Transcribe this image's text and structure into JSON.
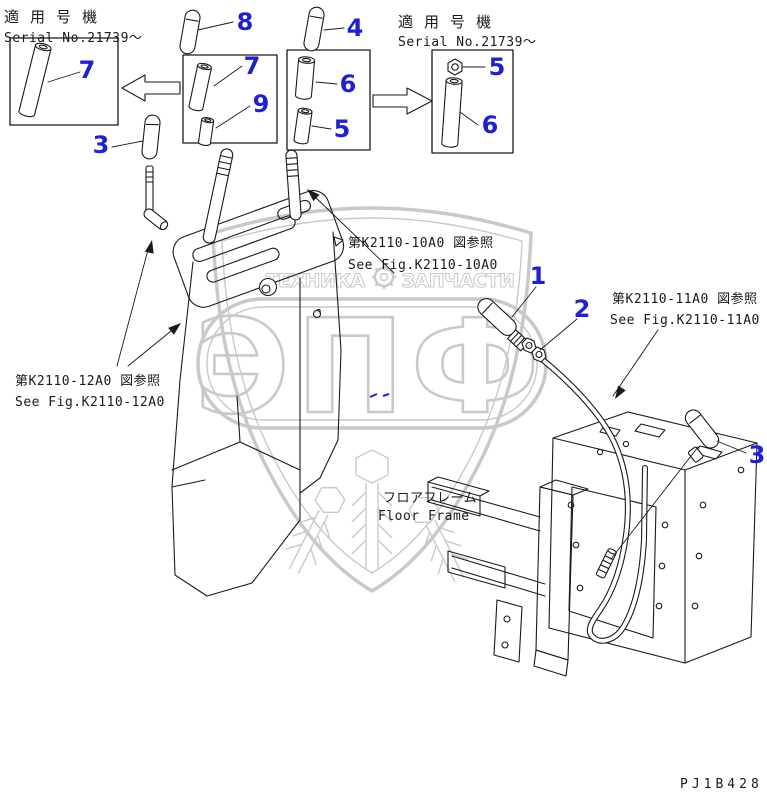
{
  "colors": {
    "ink": "#1a1a1a",
    "accent": "#1f1fd6",
    "watermark": "#c9c9c9",
    "bg": "#ffffff"
  },
  "headers": {
    "left": {
      "kanji": "適 用 号 機",
      "serial": "Serial No.21739～"
    },
    "right": {
      "kanji": "適 用 号 機",
      "serial": "Serial No.21739～"
    }
  },
  "callouts": {
    "n1": "1",
    "n2": "2",
    "n3_left": "3",
    "n3_right": "3",
    "n4": "4",
    "n5_box3": "5",
    "n5_box4": "5",
    "n6_box3": "6",
    "n6_box4": "6",
    "n7_box1": "7",
    "n7_box2": "7",
    "n8": "8",
    "n9": "9"
  },
  "refs": {
    "fig10": {
      "jp": "第K2110-10A0 図参照",
      "en": "See Fig.K2110-10A0"
    },
    "fig11": {
      "jp": "第K2110-11A0 図参照",
      "en": "See Fig.K2110-11A0"
    },
    "fig12": {
      "jp": "第K2110-12A0 図参照",
      "en": "See Fig.K2110-12A0"
    }
  },
  "floor_frame": {
    "jp": "フロアフレーム",
    "en": "Floor Frame"
  },
  "drawing_code": "PJ1B428",
  "watermark": {
    "brand": "ЭПФ",
    "tagline_left": "ТЕХНИКА",
    "tagline_right": "ЗАПЧАСТИ"
  }
}
